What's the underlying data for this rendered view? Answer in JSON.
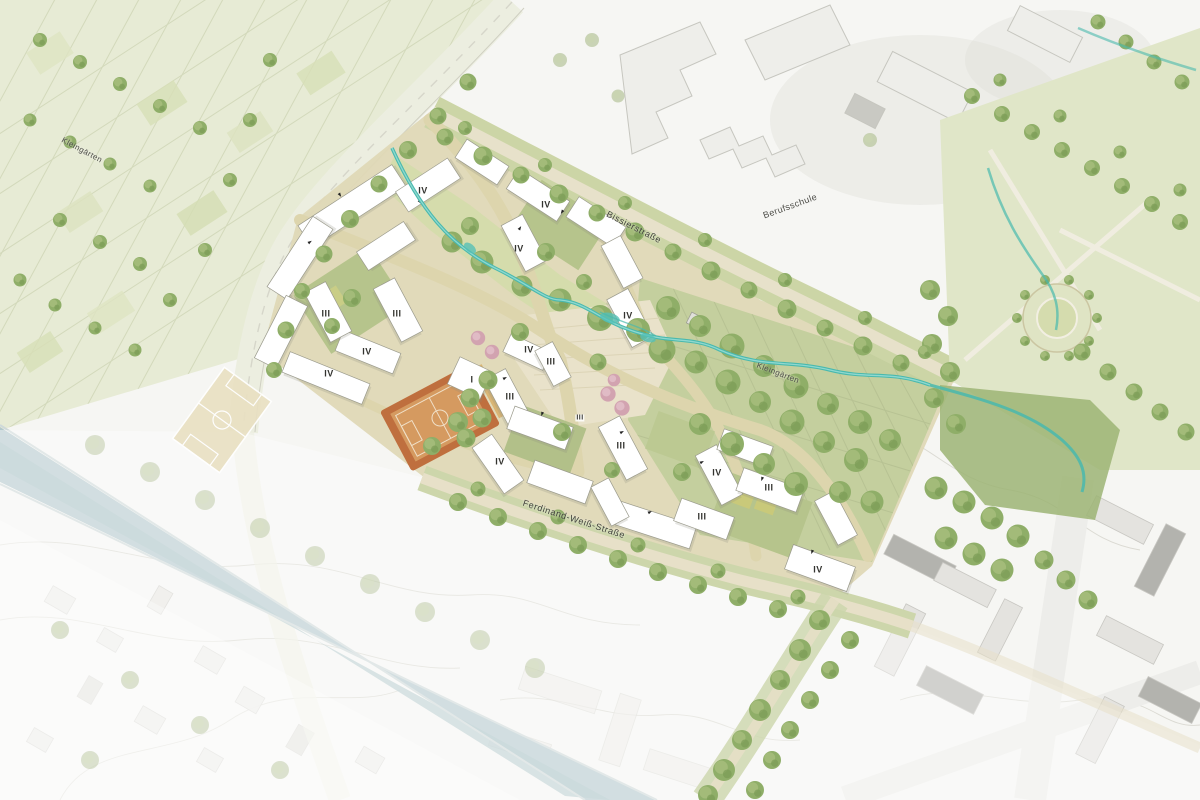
{
  "map": {
    "type": "architectural-site-plan",
    "area_labels": {
      "allotments_northwest": "Kleingärten",
      "vocational_school": "Berufsschule",
      "allotments_east": "Kleingärten"
    },
    "street_labels": {
      "north_street": "Bissierstraße",
      "south_street": "Ferdinand-Weiß-Straße"
    },
    "storey_labels": [
      {
        "text": "IV"
      },
      {
        "text": "IV"
      },
      {
        "text": "IV"
      },
      {
        "text": "III"
      },
      {
        "text": "III"
      },
      {
        "text": "IV"
      },
      {
        "text": "IV"
      },
      {
        "text": "IV"
      },
      {
        "text": "IV"
      },
      {
        "text": "III"
      },
      {
        "text": "I"
      },
      {
        "text": "III"
      },
      {
        "text": "III"
      },
      {
        "text": "III"
      },
      {
        "text": "IV"
      },
      {
        "text": "IV"
      },
      {
        "text": "III"
      },
      {
        "text": "III"
      },
      {
        "text": "IV"
      }
    ],
    "colors": {
      "stream_teal": "#49b9ae",
      "canal_water": "#b4c9cd",
      "building_white": "#ffffff",
      "path_tan": "#ddd5ad",
      "courtyard_green": "#b6c48c",
      "lawn_green": "#d4dcab",
      "tree_green": "#8fae68",
      "meadow_green": "#9cb474",
      "sport_court_orange": "#c97a44",
      "pitch_beige": "#e9e0c2",
      "blossom_pink": "#d6a8b4",
      "label_ink": "#3c3c3c"
    }
  }
}
